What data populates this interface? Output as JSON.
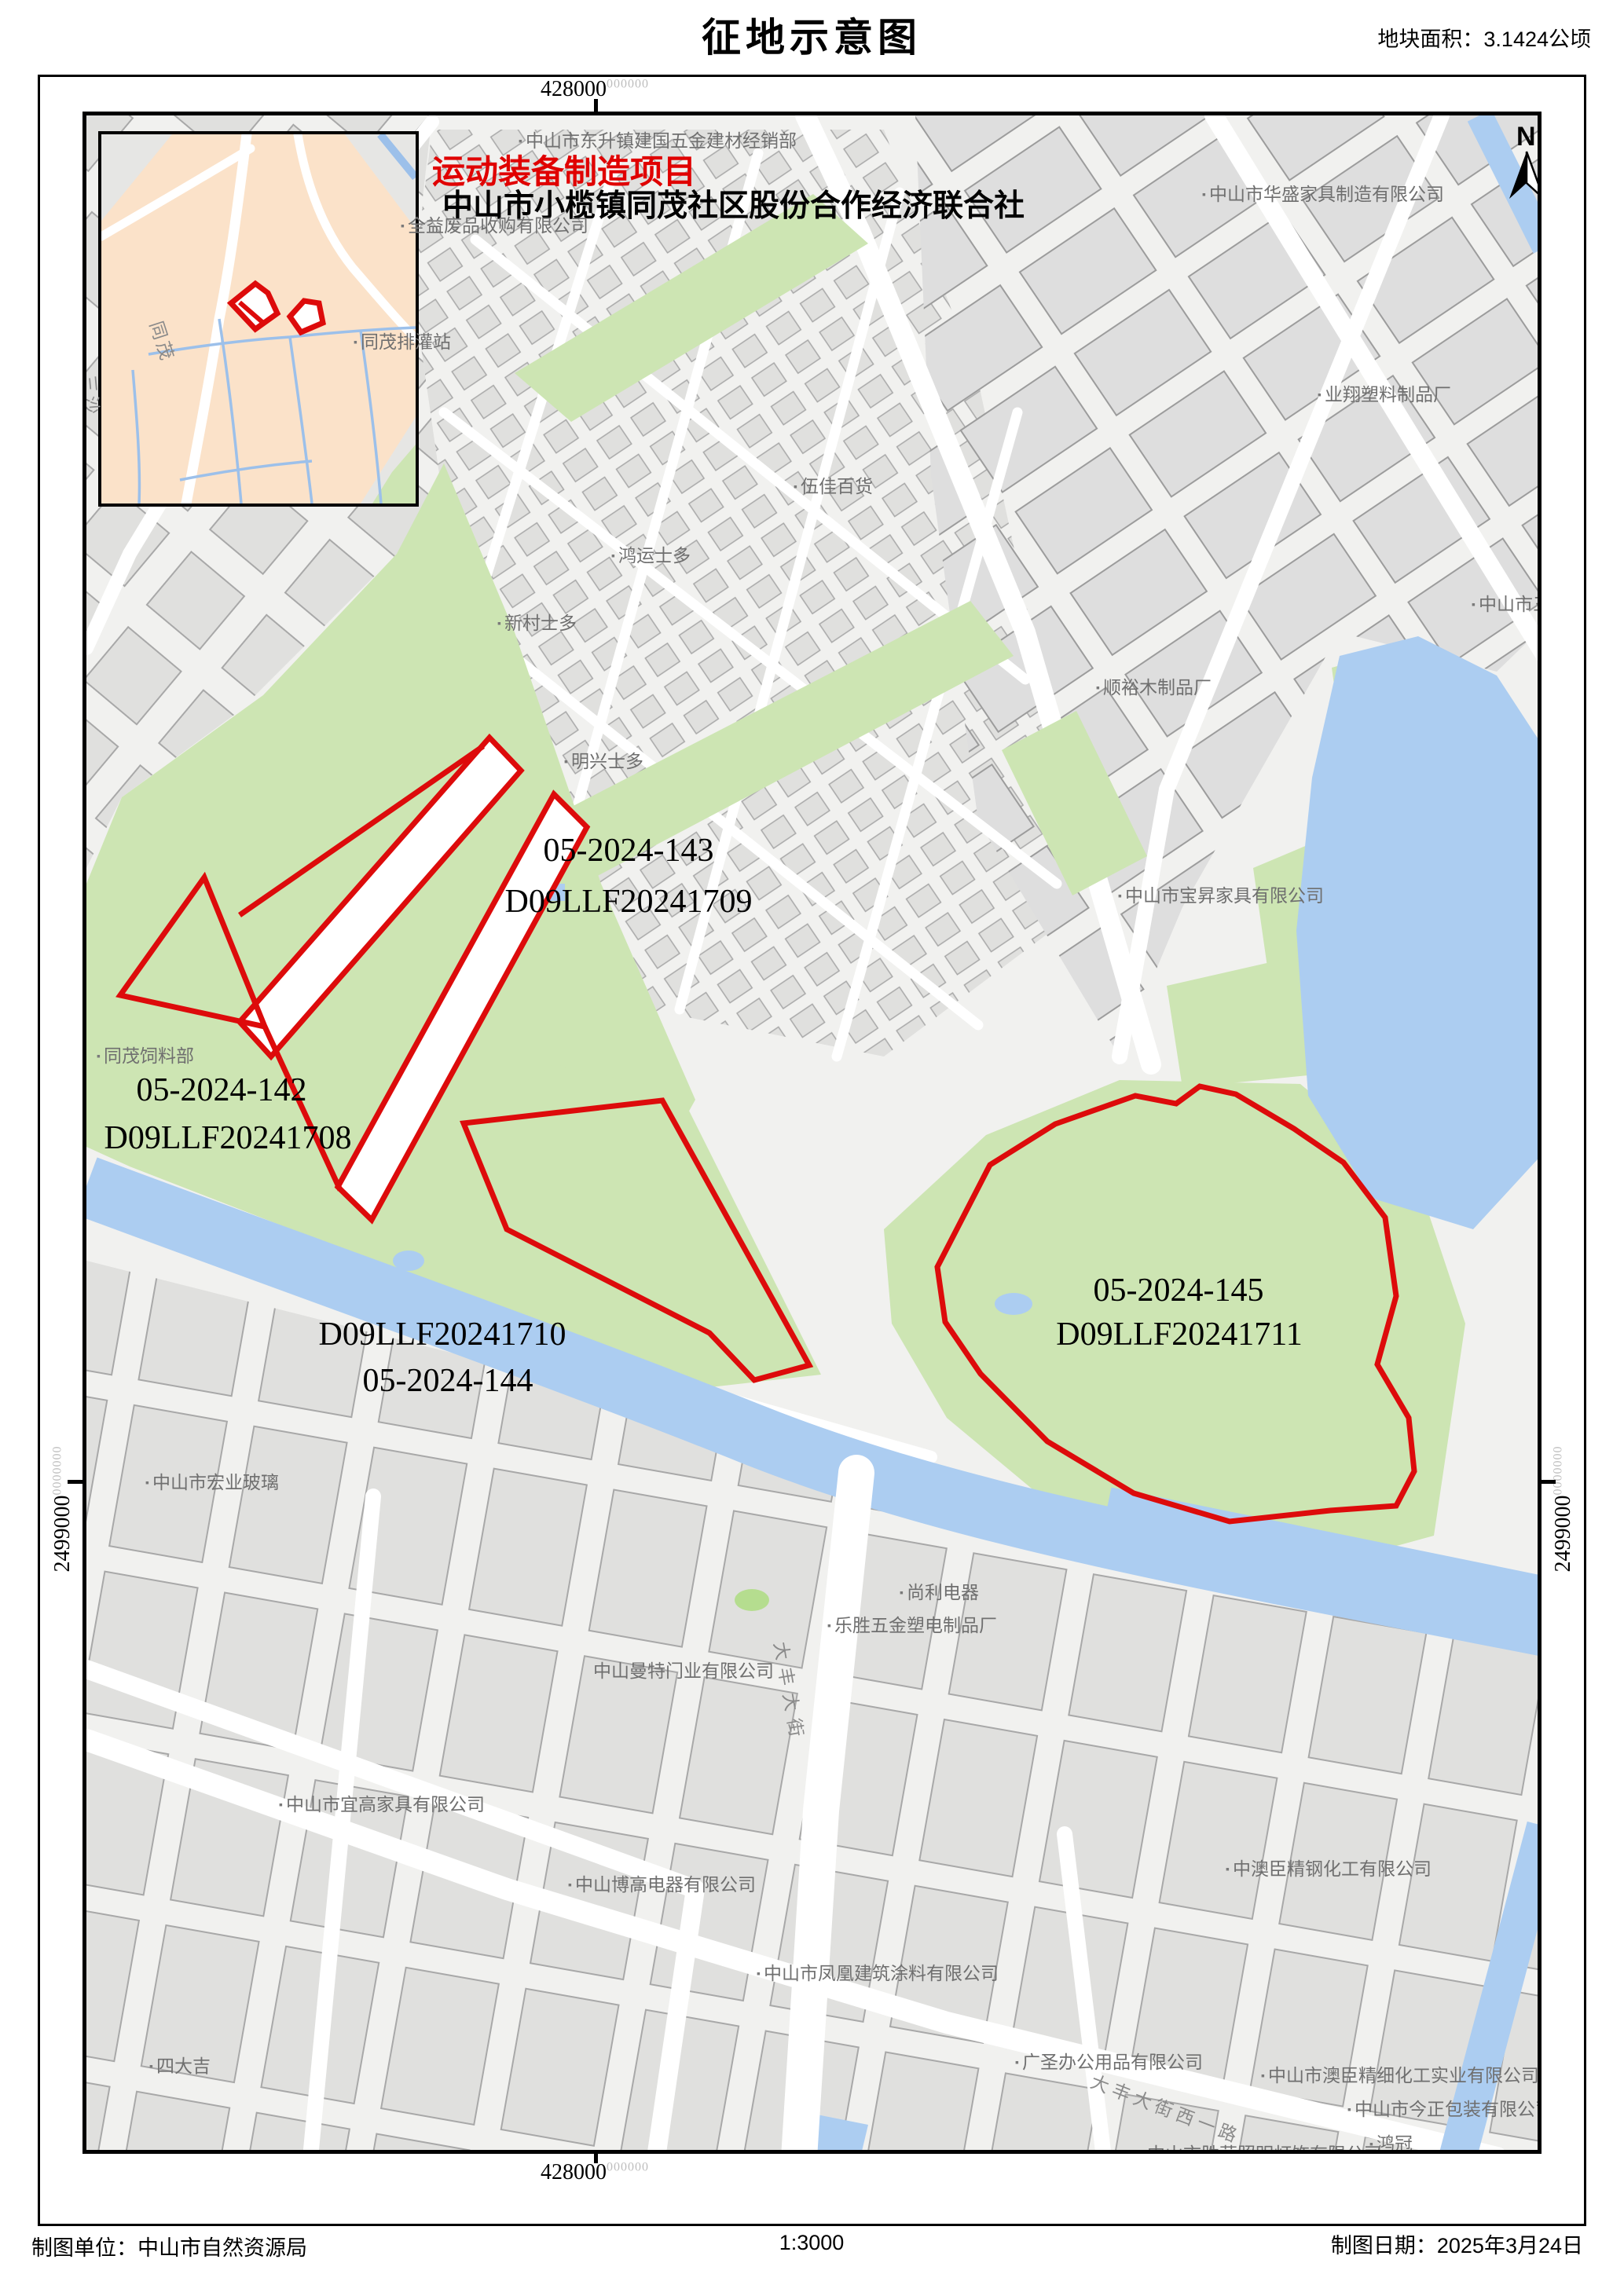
{
  "title": "征地示意图",
  "area_note": "地块面积：3.1424公顷",
  "north_label": "N",
  "header": {
    "project": "运动装备制造项目",
    "organization": "中山市小榄镇同茂社区股份合作经济联合社"
  },
  "coordinates": {
    "top": "428000",
    "top_sup": "000000",
    "bottom": "428000",
    "bottom_sup": "000000",
    "left": "2499000",
    "left_sup": "0000000",
    "right": "2499000",
    "right_sup": "0000000"
  },
  "parcels": [
    {
      "id": "05-2024-142",
      "code": "D09LLF20241708"
    },
    {
      "id": "05-2024-143",
      "code": "D09LLF20241709"
    },
    {
      "id": "05-2024-144",
      "code": "D09LLF20241710"
    },
    {
      "id": "05-2024-145",
      "code": "D09LLF20241711"
    }
  ],
  "map_labels": [
    {
      "text": "中山市东升镇建国五金建材经销部"
    },
    {
      "text": "中山市华盛家具制造有限公司"
    },
    {
      "text": "全益废品收购有限公司"
    },
    {
      "text": "同茂排灌站"
    },
    {
      "text": "业翔塑料制品厂"
    },
    {
      "text": "伍佳百货"
    },
    {
      "text": "鸿运士多"
    },
    {
      "text": "新村士多"
    },
    {
      "text": "中山市三禾"
    },
    {
      "text": "顺裕木制品厂"
    },
    {
      "text": "明兴士多"
    },
    {
      "text": "中山市宝昇家具有限公司"
    },
    {
      "text": "同茂饲料部"
    },
    {
      "text": "中山市宏业玻璃"
    },
    {
      "text": "尚利电器"
    },
    {
      "text": "乐胜五金塑电制品厂"
    },
    {
      "text": "中山曼特门业有限公司"
    },
    {
      "text": "中山市宜高家具有限公司"
    },
    {
      "text": "中山博高电器有限公司"
    },
    {
      "text": "中澳臣精钢化工有限公司"
    },
    {
      "text": "中山市凤凰建筑涂料有限公司"
    },
    {
      "text": "四大吉"
    },
    {
      "text": "广圣办公用品有限公司"
    },
    {
      "text": "中山市澳臣精细化工实业有限公司"
    },
    {
      "text": "中山市今正包装有限公司"
    },
    {
      "text": "鸿冠"
    },
    {
      "text": "中山市胜荣照明灯饰有限公司"
    },
    {
      "text": "大丰大街"
    },
    {
      "text": "大丰大街西一路"
    },
    {
      "text": "同茂"
    },
    {
      "text": "三沙"
    }
  ],
  "footer": {
    "left": "制图单位：中山市自然资源局",
    "scale": "1:3000",
    "right": "制图日期：2025年3月24日"
  },
  "colors": {
    "parcel_outline": "#dd0b0b",
    "green_area": "#cde5b3",
    "water": "#accdf1",
    "inset_background": "#fbe2c9"
  }
}
